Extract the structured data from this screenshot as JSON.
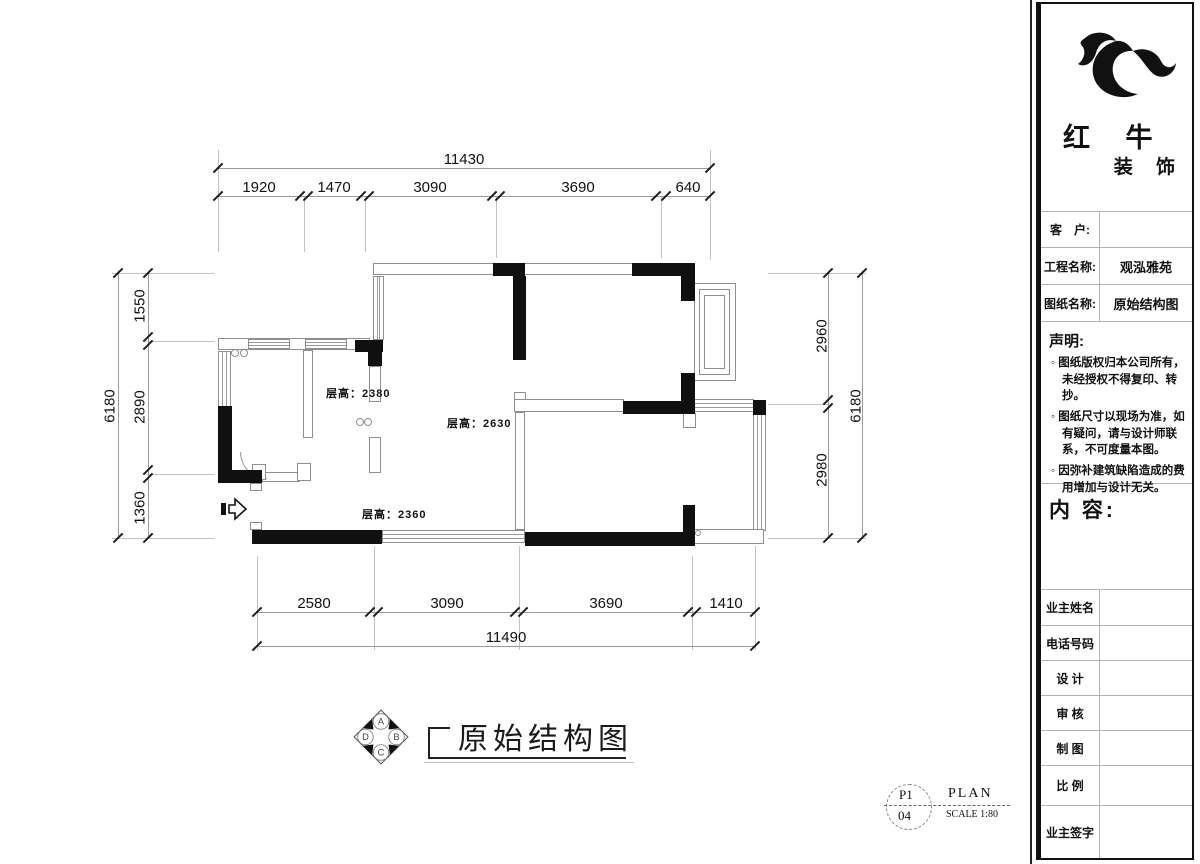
{
  "palette": {
    "ink": "#111111",
    "wall_gray": "#8f8f8f",
    "dim_gray": "#9b9b9b"
  },
  "dimensions": {
    "top": {
      "total": "11430",
      "segments": [
        "1920",
        "1470",
        "3090",
        "3690",
        "640"
      ]
    },
    "bottom": {
      "total": "11490",
      "segments": [
        "2580",
        "3090",
        "3690",
        "1410"
      ]
    },
    "left": {
      "total": "6180",
      "segments": [
        "1550",
        "2890",
        "1360"
      ]
    },
    "right": {
      "total": "6180",
      "segments": [
        "2960",
        "2980"
      ]
    }
  },
  "drawing": {
    "title": "原始结构图",
    "room_heights": {
      "room1": "层高：2380",
      "room2": "层高：2630",
      "room3": "层高：2360"
    },
    "compass": {
      "top": "A",
      "right": "B",
      "bottom": "C",
      "left": "D"
    }
  },
  "sheet_stamp": {
    "code_top": "P1",
    "code_bottom": "04",
    "label": "PLAN",
    "scale": "SCALE 1:80"
  },
  "brand": {
    "name_top": "红 牛",
    "name_bottom": "装 饰"
  },
  "title_block": {
    "rows": [
      {
        "label": "客　户:",
        "value": ""
      },
      {
        "label": "工程名称:",
        "value": "观泓雅苑"
      },
      {
        "label": "图纸名称:",
        "value": "原始结构图"
      }
    ],
    "statement_heading": "声明:",
    "statement_items": [
      "图纸版权归本公司所有，未经授权不得复印、转抄。",
      "图纸尺寸以现场为准，如有疑问，请与设计师联系，不可度量本图。",
      "因弥补建筑缺陷造成的费用增加与设计无关。"
    ],
    "content_heading": "内 容:",
    "footer_rows": [
      {
        "label": "业主姓名",
        "value": ""
      },
      {
        "label": "电话号码",
        "value": ""
      },
      {
        "label": "设 计",
        "value": ""
      },
      {
        "label": "审 核",
        "value": ""
      },
      {
        "label": "制 图",
        "value": ""
      },
      {
        "label": "比 例",
        "value": ""
      },
      {
        "label": "业主签字",
        "value": ""
      }
    ]
  }
}
